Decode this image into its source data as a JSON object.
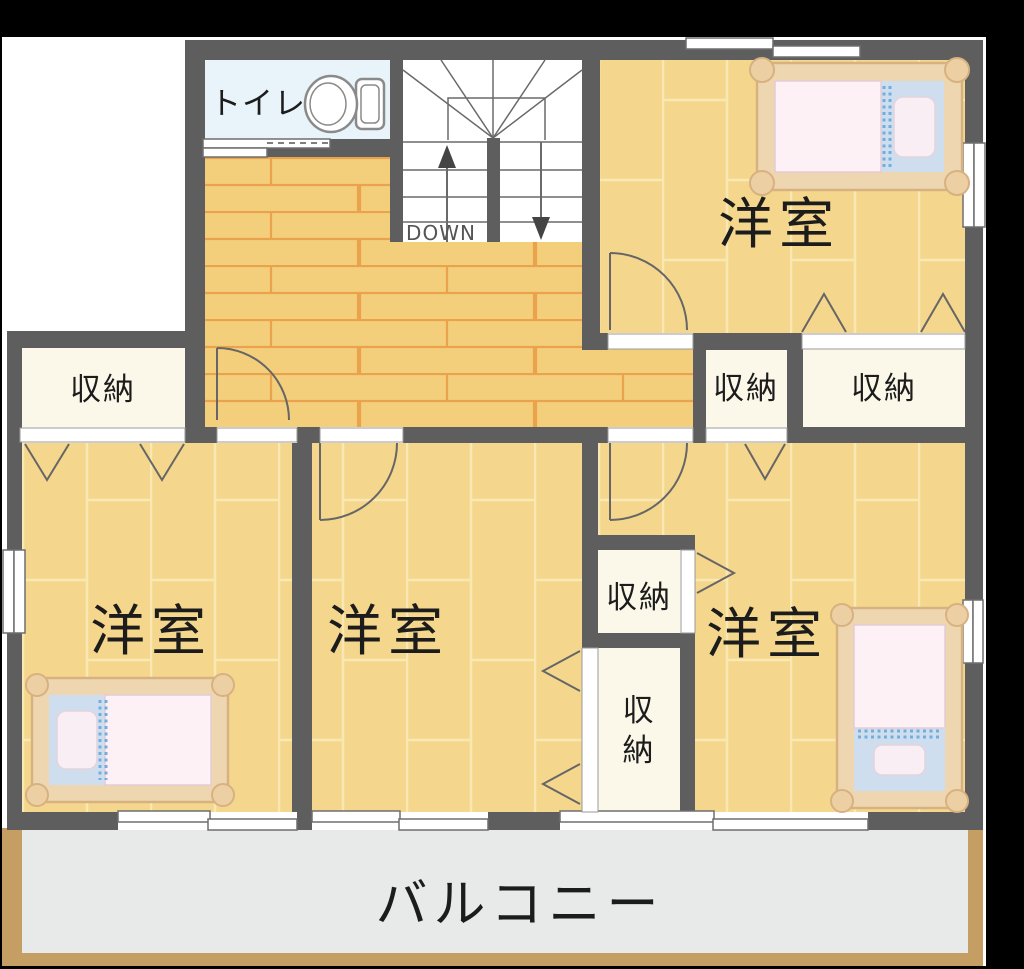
{
  "floor_plan": {
    "labels": {
      "toilet": "トイレ",
      "stairs_direction": "DOWN",
      "room_ne": "洋室",
      "room_sw": "洋室",
      "room_s": "洋室",
      "room_se": "洋室",
      "storage_west": "収納",
      "storage_center_small": "収納",
      "storage_center_wide": "収納",
      "storage_mid": "収納",
      "storage_tall_top": "収",
      "storage_tall_bottom": "納",
      "balcony": "バルコニー"
    },
    "colors": {
      "background": "#000000",
      "page": "#ffffff",
      "wall": "#5e5e5e",
      "room_floor": "#f4d78c",
      "room_floor_line": "#f9e7b4",
      "hall_floor": "#f3cf7c",
      "hall_floor_line": "#eaa24c",
      "toilet_floor": "#e9f4fa",
      "closet_floor": "#fbf8ea",
      "balcony_floor": "#e8e9e9",
      "balcony_border": "#c49e63",
      "bed_frame": "#eed7b0",
      "bed_frame_edge": "#d8b181",
      "bed_blanket": "#fdf1f5",
      "bed_sheet": "#cfdeee",
      "bed_pillow": "#f8eef3",
      "bed_dots": "#72aedd",
      "door_line": "#666666",
      "window_line": "#6e6e6e"
    }
  }
}
